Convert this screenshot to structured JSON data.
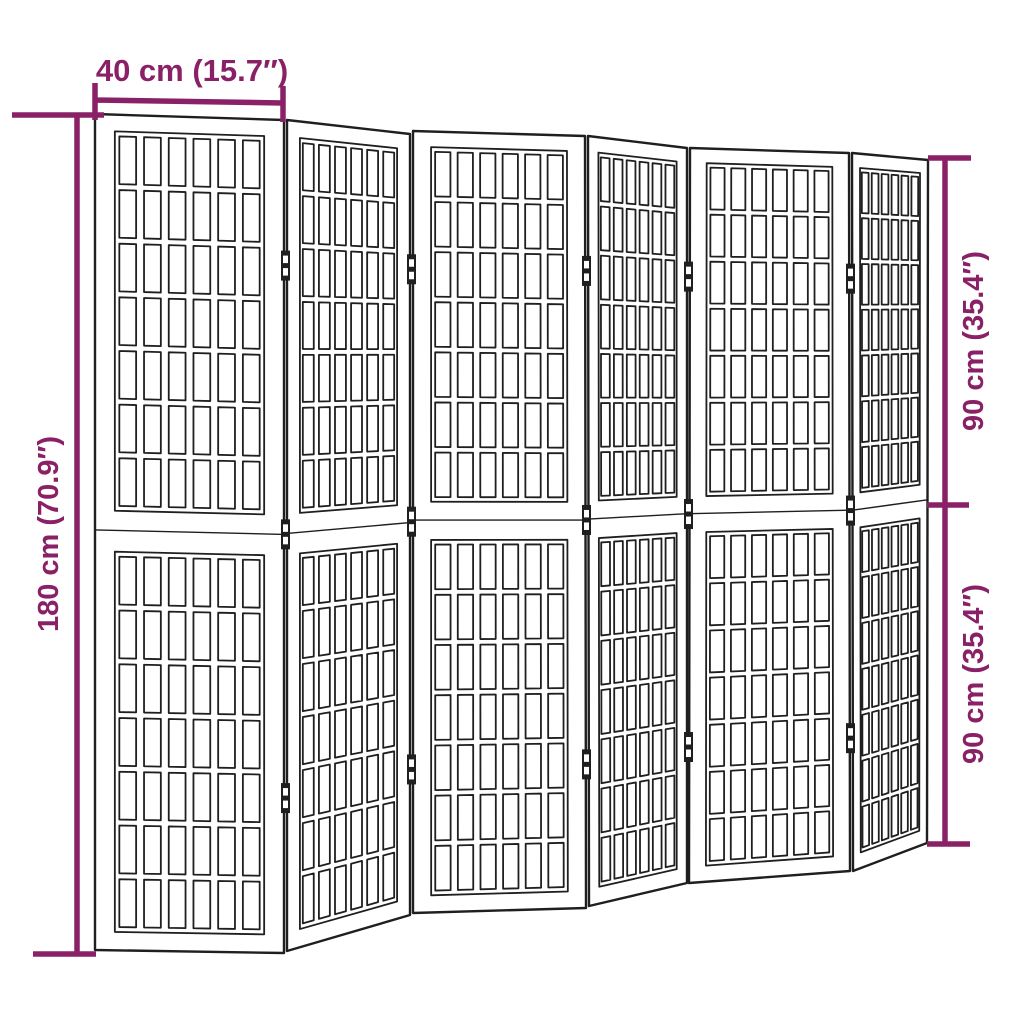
{
  "colors": {
    "dimension_annotation": "#8a2167",
    "line_art": "#1f1f1f",
    "panel_fill": "#ffffff",
    "background": "#ffffff"
  },
  "dimensions": {
    "top_width": {
      "label": "40 cm (15.7″)",
      "cm": 40,
      "inches": 15.7
    },
    "left_height": {
      "label": "180 cm (70.9″)",
      "cm": 180,
      "inches": 70.9
    },
    "right_upper_height": {
      "label": "90 cm (35.4″)",
      "cm": 90,
      "inches": 35.4
    },
    "right_lower_height": {
      "label": "90 cm (35.4″)",
      "cm": 90,
      "inches": 35.4
    }
  },
  "figure": {
    "subject": "6-panel folding room divider with shoji-style lattice panels",
    "panel_count": 6,
    "sections_per_panel": 2,
    "lattice_columns": 6,
    "lattice_rows_per_section": 7,
    "hinges_per_joint": 3,
    "panel_corners": [
      [
        [
          95,
          114
        ],
        [
          284,
          120
        ],
        [
          284,
          953
        ],
        [
          95,
          950
        ]
      ],
      [
        [
          287,
          120
        ],
        [
          410,
          134
        ],
        [
          410,
          915
        ],
        [
          287,
          951
        ]
      ],
      [
        [
          413,
          131
        ],
        [
          585,
          136
        ],
        [
          586,
          908
        ],
        [
          413,
          913
        ]
      ],
      [
        [
          588,
          136
        ],
        [
          687,
          148
        ],
        [
          687,
          883
        ],
        [
          589,
          906
        ]
      ],
      [
        [
          690,
          148
        ],
        [
          849,
          153
        ],
        [
          850,
          871
        ],
        [
          689,
          883
        ]
      ],
      [
        [
          852,
          153
        ],
        [
          928,
          160
        ],
        [
          927,
          843
        ],
        [
          853,
          871
        ]
      ]
    ]
  }
}
